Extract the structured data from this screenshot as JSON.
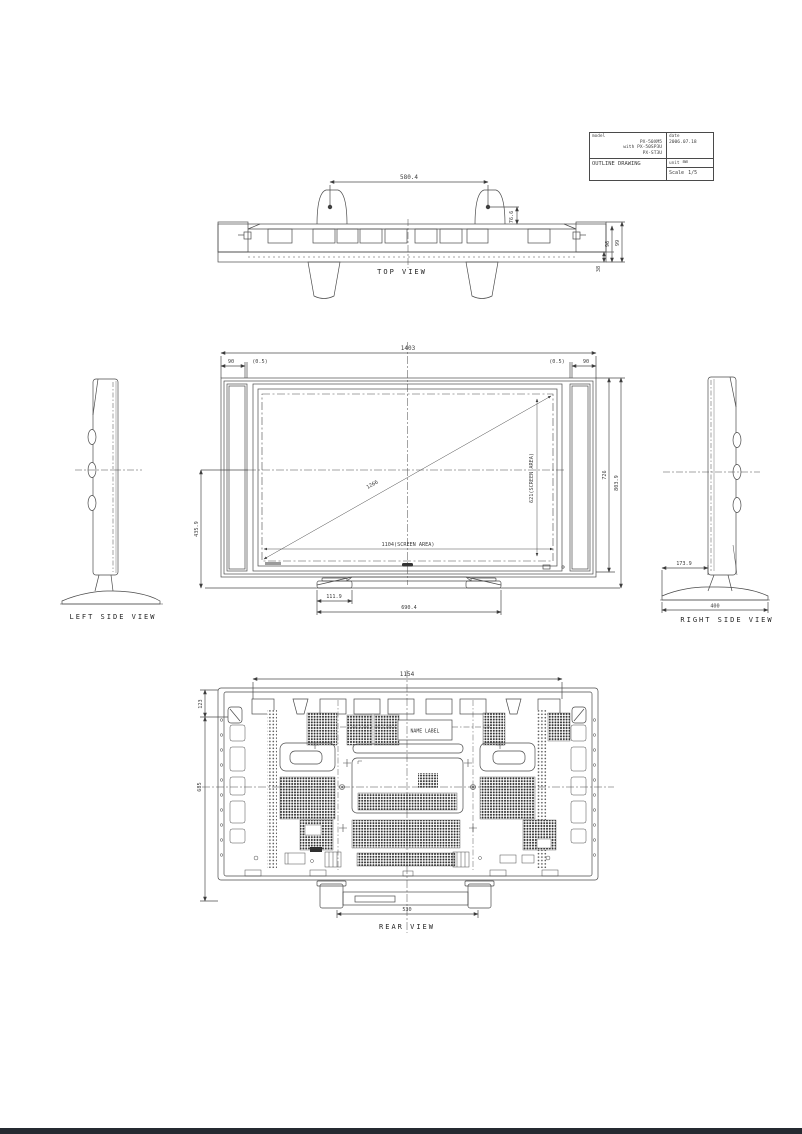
{
  "title_block": {
    "model_label": "model",
    "model_line1": "PX-50XM5",
    "model_line2": "with PX-50SP3U",
    "model_line3": "PX-ST3U",
    "drawing_title": "OUTLINE DRAWING",
    "date_label": "date",
    "date_value": "2006.07.18",
    "unit_label": "unit",
    "unit_value": "mm",
    "scale_label": "Scale",
    "scale_value": "1/5"
  },
  "top_view": {
    "label": "TOP VIEW",
    "dim_stand_pitch": "580.4",
    "dim_stand_depth": "76.6",
    "dim_depth_body": "96",
    "dim_depth_total": "99",
    "dim_bottom_offset": "38"
  },
  "front_view": {
    "dim_overall_width": "1403",
    "dim_left_bezel": "90",
    "dim_left_gap": "(0.5)",
    "dim_right_gap": "(0.5)",
    "dim_right_bezel": "90",
    "dim_diagonal": "1266",
    "dim_screen_height": "621(SCREEN AREA)",
    "dim_screen_width": "1104(SCREEN AREA)",
    "dim_panel_height": "726",
    "dim_total_height": "803.9",
    "dim_center_height": "435.9",
    "dim_foot_width": "111.9",
    "dim_feet_pitch": "690.4"
  },
  "left_side_view": {
    "label": "LEFT SIDE VIEW"
  },
  "right_side_view": {
    "label": "RIGHT SIDE VIEW",
    "dim_panel_offset": "173.9",
    "dim_base_depth": "400"
  },
  "rear_view": {
    "label": "REAR VIEW",
    "dim_mount_width": "1154",
    "dim_top_offset": "123",
    "dim_mount_height": "685",
    "dim_feet_pitch": "530",
    "name_label_text": "NAME LABEL"
  }
}
